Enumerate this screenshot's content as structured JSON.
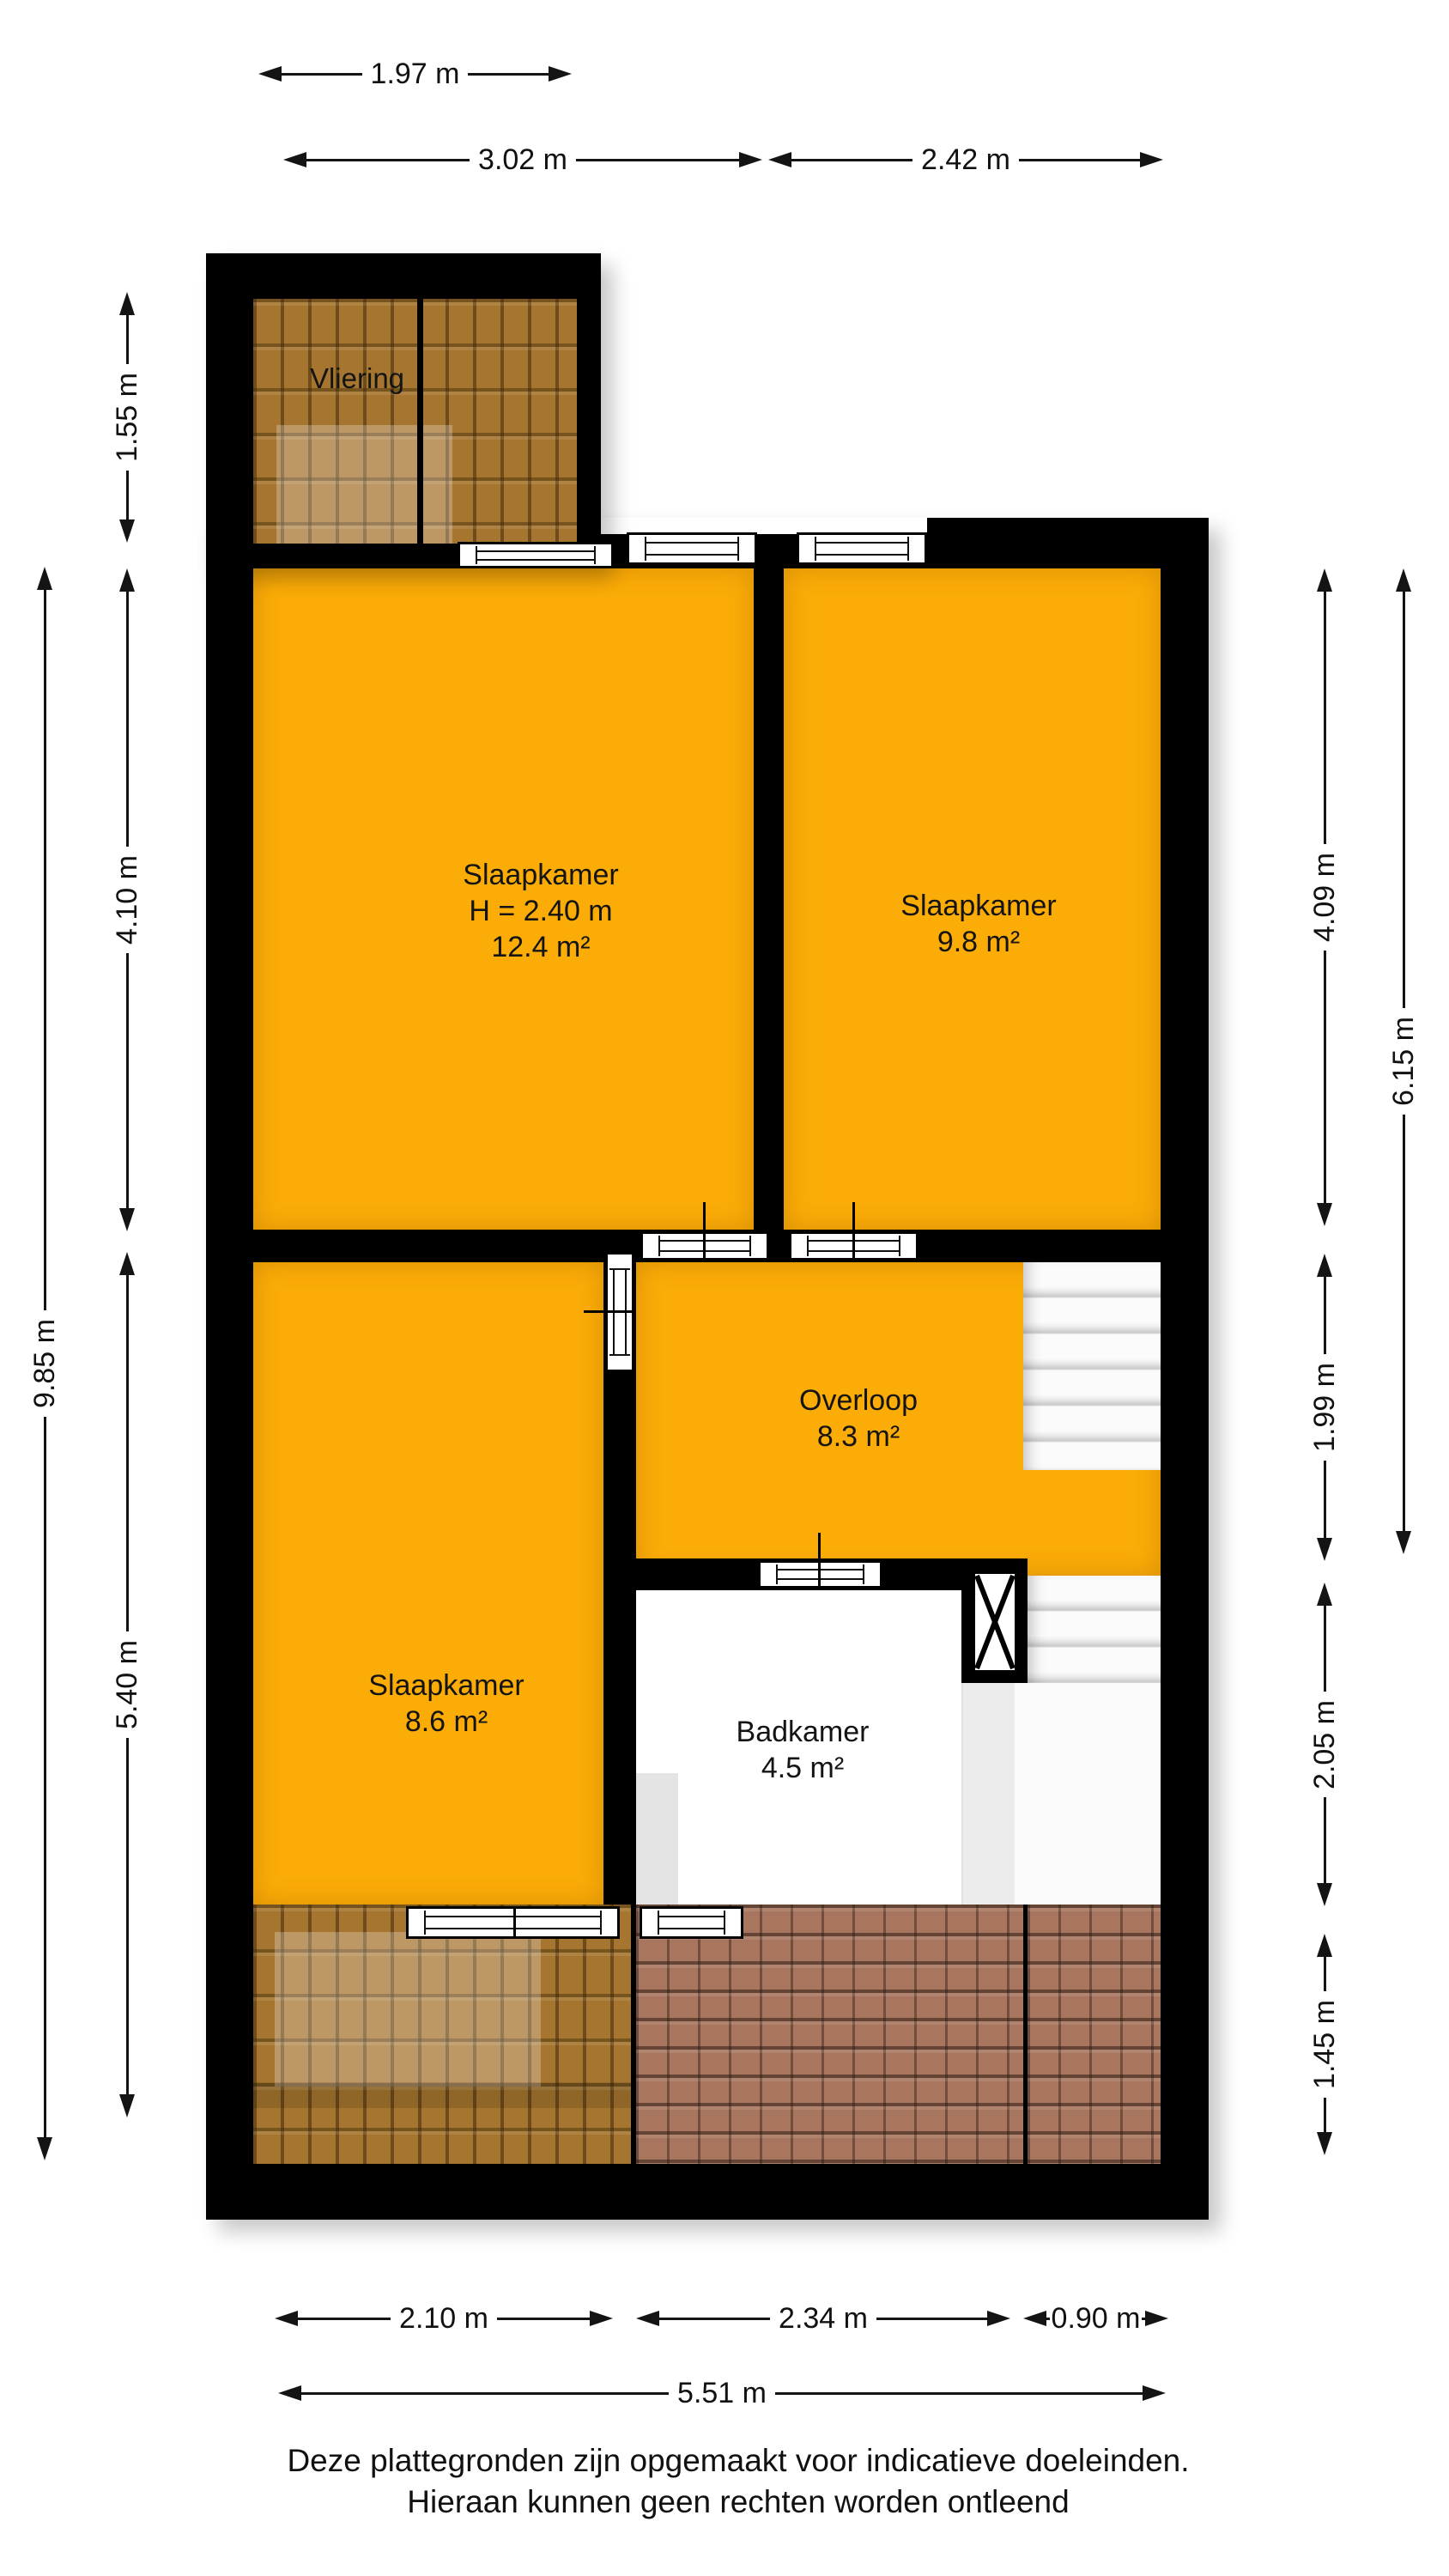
{
  "plan_type": "floorplan-upper-floor",
  "rooms": {
    "vliering": {
      "name": "Vliering"
    },
    "slaapkamer_groot": {
      "name": "Slaapkamer",
      "height": "H = 2.40 m",
      "area": "12.4 m²"
    },
    "slaapkamer_rechts": {
      "name": "Slaapkamer",
      "area": "9.8 m²"
    },
    "overloop": {
      "name": "Overloop",
      "area": "8.3 m²"
    },
    "slaapkamer_links": {
      "name": "Slaapkamer",
      "area": "8.6 m²"
    },
    "badkamer": {
      "name": "Badkamer",
      "area": "4.5 m²"
    }
  },
  "dims": {
    "top": [
      "1.97 m",
      "3.02 m",
      "2.42 m"
    ],
    "left": [
      "1.55 m",
      "4.10 m",
      "5.40 m",
      "9.85 m"
    ],
    "right": [
      "4.09 m",
      "1.99 m",
      "2.05 m",
      "1.45 m",
      "6.15 m"
    ],
    "bottom": [
      "2.10 m",
      "2.34 m",
      "0.90 m",
      "5.51 m"
    ]
  },
  "footer": {
    "line1": "Deze plattegronden zijn opgemaakt voor indicatieve doeleinden.",
    "line2": "Hieraan kunnen geen rechten worden ontleend"
  },
  "colors": {
    "wall": "#000000",
    "room_floor": "#FBAC07",
    "roof_brown": "#A6752F",
    "roof_mauve": "#A8765F",
    "stairs": "#F2F2F2",
    "background": "#FFFFFF"
  }
}
